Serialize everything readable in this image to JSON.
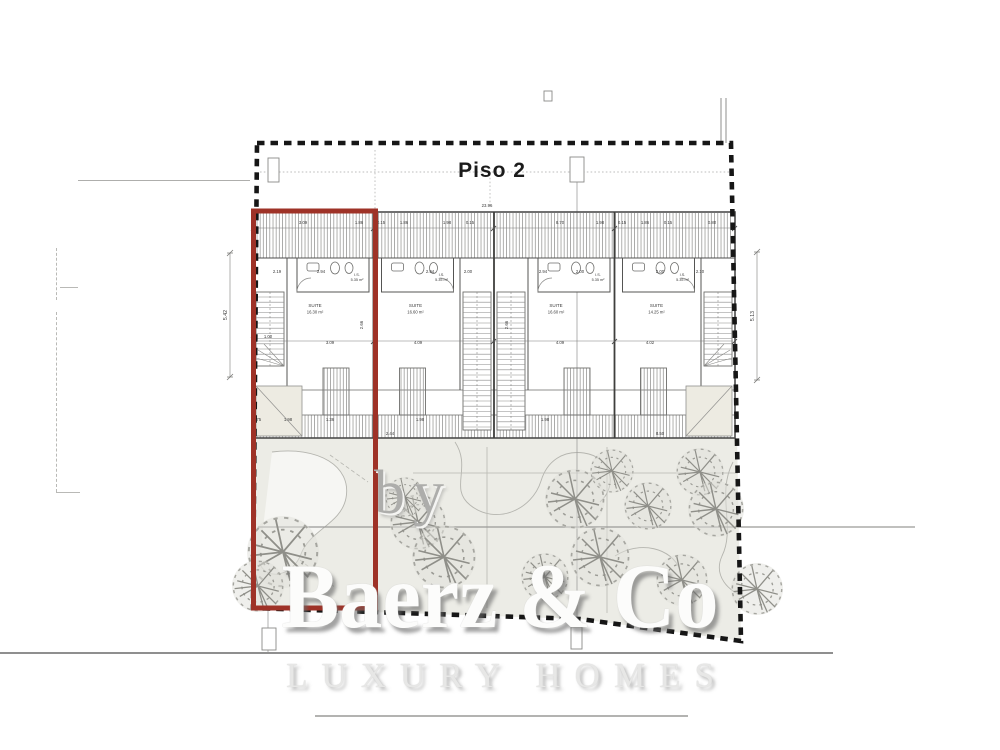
{
  "title": "Piso 2",
  "watermark": {
    "by": "by",
    "brand": "Baerz & Co",
    "tagline": "LUXURY HOMES"
  },
  "colors": {
    "highlight_red": "#9e3227",
    "boundary_black": "#161616",
    "wall_gray": "#4c4c4c",
    "garden_fill": "#ecece6",
    "watermark_gray": "#c9c9c9"
  },
  "units": [
    {
      "id": 1,
      "room": "SUITE",
      "area": "16.30 m²",
      "bath": "I.S.",
      "bath_area": "5.35 m²",
      "mirrored": false,
      "highlighted": true
    },
    {
      "id": 2,
      "room": "SUITE",
      "area": "16.60 m²",
      "bath": "I.S.",
      "bath_area": "5.35 m²",
      "mirrored": true,
      "highlighted": false
    },
    {
      "id": 3,
      "room": "SUITE",
      "area": "16.60 m²",
      "bath": "I.S.",
      "bath_area": "5.35 m²",
      "mirrored": false,
      "highlighted": false
    },
    {
      "id": 4,
      "room": "SUITE",
      "area": "14.25 m²",
      "bath": "I.S.",
      "bath_area": "5.35 m²",
      "mirrored": true,
      "highlighted": false
    }
  ],
  "annotations": [
    {
      "x": 487,
      "y": 207,
      "t": "23.96"
    },
    {
      "x": 303,
      "y": 224,
      "t": "3.09"
    },
    {
      "x": 359,
      "y": 224,
      "t": "1.86"
    },
    {
      "x": 381,
      "y": 224,
      "t": "0.15"
    },
    {
      "x": 404,
      "y": 224,
      "t": "1.86"
    },
    {
      "x": 447,
      "y": 224,
      "t": "1.98"
    },
    {
      "x": 470,
      "y": 224,
      "t": "0.15"
    },
    {
      "x": 560,
      "y": 224,
      "t": "8.70"
    },
    {
      "x": 600,
      "y": 224,
      "t": "1.98"
    },
    {
      "x": 622,
      "y": 224,
      "t": "0.15"
    },
    {
      "x": 645,
      "y": 224,
      "t": "1.86"
    },
    {
      "x": 668,
      "y": 224,
      "t": "0.15"
    },
    {
      "x": 712,
      "y": 224,
      "t": "0.80"
    },
    {
      "x": 277,
      "y": 273,
      "t": "2.19"
    },
    {
      "x": 321,
      "y": 273,
      "t": "2.94"
    },
    {
      "x": 430,
      "y": 273,
      "t": "2.94"
    },
    {
      "x": 468,
      "y": 273,
      "t": "2.00"
    },
    {
      "x": 543,
      "y": 273,
      "t": "2.94"
    },
    {
      "x": 580,
      "y": 273,
      "t": "2.00"
    },
    {
      "x": 660,
      "y": 273,
      "t": "2.00"
    },
    {
      "x": 700,
      "y": 273,
      "t": "2.10"
    },
    {
      "x": 268,
      "y": 338,
      "t": "1.00"
    },
    {
      "x": 330,
      "y": 344,
      "t": "3.09"
    },
    {
      "x": 418,
      "y": 344,
      "t": "4.09"
    },
    {
      "x": 560,
      "y": 344,
      "t": "4.09"
    },
    {
      "x": 650,
      "y": 344,
      "t": "4.02"
    },
    {
      "x": 363,
      "y": 325,
      "t": "2.66",
      "r": -90
    },
    {
      "x": 508,
      "y": 325,
      "t": "2.66",
      "r": -90
    },
    {
      "x": 227,
      "y": 315,
      "t": "5.42",
      "r": -90,
      "s": 5.2
    },
    {
      "x": 754,
      "y": 316,
      "t": "5.13",
      "r": -90,
      "s": 5.2
    },
    {
      "x": 257,
      "y": 421,
      "t": "0.75"
    },
    {
      "x": 288,
      "y": 421,
      "t": "1.98"
    },
    {
      "x": 330,
      "y": 421,
      "t": "1.36"
    },
    {
      "x": 420,
      "y": 421,
      "t": "1.98"
    },
    {
      "x": 545,
      "y": 421,
      "t": "1.98"
    },
    {
      "x": 390,
      "y": 435,
      "t": "2.44"
    },
    {
      "x": 660,
      "y": 435,
      "t": "8.50"
    }
  ],
  "trees": [
    {
      "x": 283,
      "y": 552,
      "s": 3.6
    },
    {
      "x": 258,
      "y": 586,
      "s": 2.6
    },
    {
      "x": 418,
      "y": 522,
      "s": 2.8
    },
    {
      "x": 444,
      "y": 557,
      "s": 3.2
    },
    {
      "x": 405,
      "y": 497,
      "s": 2.0
    },
    {
      "x": 575,
      "y": 499,
      "s": 3.0
    },
    {
      "x": 612,
      "y": 471,
      "s": 2.2
    },
    {
      "x": 600,
      "y": 557,
      "s": 3.0
    },
    {
      "x": 648,
      "y": 506,
      "s": 2.4
    },
    {
      "x": 700,
      "y": 472,
      "s": 2.4
    },
    {
      "x": 716,
      "y": 509,
      "s": 2.8
    },
    {
      "x": 682,
      "y": 580,
      "s": 2.6
    },
    {
      "x": 545,
      "y": 577,
      "s": 2.4
    },
    {
      "x": 757,
      "y": 589,
      "s": 2.6
    }
  ]
}
